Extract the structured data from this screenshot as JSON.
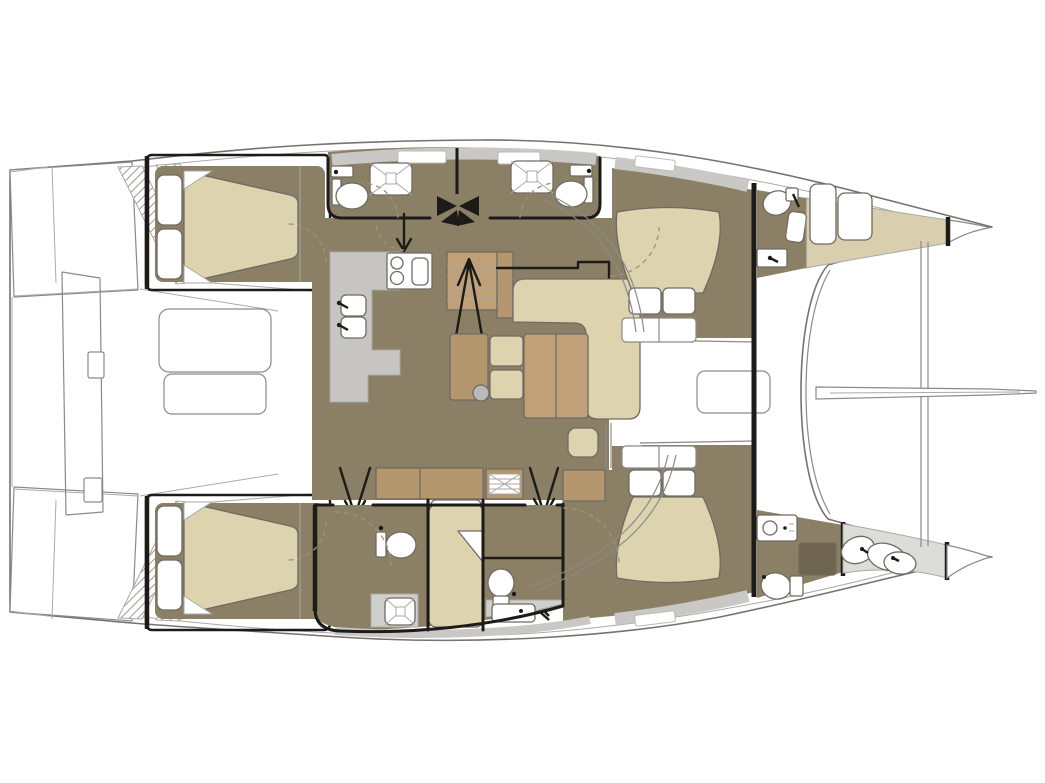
{
  "diagram": {
    "type": "boat-floor-plan",
    "subject": "Sailing catamaran interior layout plan, top-down view",
    "orientation": {
      "bow": "right",
      "stern": "left",
      "port_hull": "top",
      "starboard_hull": "bottom"
    },
    "text_labels": []
  },
  "palette": {
    "white": "#ffffff",
    "floor_taupe": "#8b7f66",
    "bed_cream": "#ddd3af",
    "wood_brown": "#b5976f",
    "wood_brown_light": "#c0a078",
    "galley_gray": "#c6c5c1",
    "counter_gray": "#cfcfcb",
    "deck_band_gray": "#c9c8c4",
    "forepeak_tan": "#d9cfae",
    "crew_gray": "#dcdcd8",
    "shower_dark": "#6e6450",
    "pouf_gray": "#b9b9b9",
    "line_black": "#1d1b18",
    "line_gray": "#8a8a8a",
    "line_light": "#aaaaa6",
    "hull_line": "#77736c",
    "fixture_line": "#6f6b63",
    "dash_tan": "#a39177"
  },
  "areas": {
    "stern": {
      "name": "Stern",
      "features": [
        "port transom swim steps",
        "starboard transom swim steps",
        "central aft walkway platform"
      ]
    },
    "aft_cockpit": {
      "name": "Aft cockpit",
      "features": [
        "cockpit table",
        "cockpit bench",
        "sliding door to salon"
      ]
    },
    "salon": {
      "name": "Salon",
      "features": [
        "L-shaped sofa",
        "dinette table with two seats",
        "double coffee table",
        "ottoman pouf",
        "stool",
        "sideboard cabinets",
        "stairs up with arrow"
      ]
    },
    "galley": {
      "name": "Galley",
      "features": [
        "two-burner stove with worktop",
        "double sink with faucets",
        "L-shaped counter floor"
      ]
    },
    "port_hull": {
      "name": "Port hull (top)",
      "cabins": [
        {
          "name": "Aft double cabin",
          "fixtures": [
            "double berth with two pillows",
            "hanging locker"
          ]
        },
        {
          "name": "Aft bathroom",
          "fixtures": [
            "shower",
            "toilet",
            "washbasin"
          ]
        },
        {
          "name": "Forward bathroom",
          "fixtures": [
            "shower",
            "toilet",
            "washbasin"
          ]
        },
        {
          "name": "Companionway steps",
          "fixtures": [
            "black step fan",
            "down arrow"
          ]
        },
        {
          "name": "Forward double cabin",
          "fixtures": [
            "island berth with two pillows",
            "bed steps"
          ]
        },
        {
          "name": "Bow head",
          "fixtures": [
            "toilet",
            "washbasin",
            "seat"
          ]
        },
        {
          "name": "Forepeak",
          "fixtures": [
            "berth cushions",
            "collision bulkhead"
          ]
        }
      ]
    },
    "starboard_hull": {
      "name": "Starboard hull (bottom)",
      "cabins": [
        {
          "name": "Aft double cabin",
          "fixtures": [
            "double berth with two pillows",
            "hanging locker"
          ]
        },
        {
          "name": "Aft bathroom",
          "fixtures": [
            "toilet",
            "shower"
          ]
        },
        {
          "name": "Single berth cabin",
          "fixtures": [
            "single berth with pillow"
          ]
        },
        {
          "name": "Forward bathroom",
          "fixtures": [
            "toilet",
            "washbasin counter"
          ]
        },
        {
          "name": "Forward double cabin",
          "fixtures": [
            "island berth with two pillows",
            "wardrobe cabinet",
            "two down arrows to companionways"
          ]
        },
        {
          "name": "Bow compartment",
          "fixtures": [
            "washer unit",
            "dark shower tray",
            "toilet"
          ]
        },
        {
          "name": "Crew / forepeak area",
          "fixtures": [
            "berth cushions",
            "collision bulkhead"
          ]
        }
      ]
    },
    "foredeck": {
      "name": "Foredeck & trampoline",
      "features": [
        "deck hatch / sunpad",
        "main bulkhead",
        "curved forward beam",
        "trampoline crossbeam",
        "bowsprit"
      ]
    }
  }
}
